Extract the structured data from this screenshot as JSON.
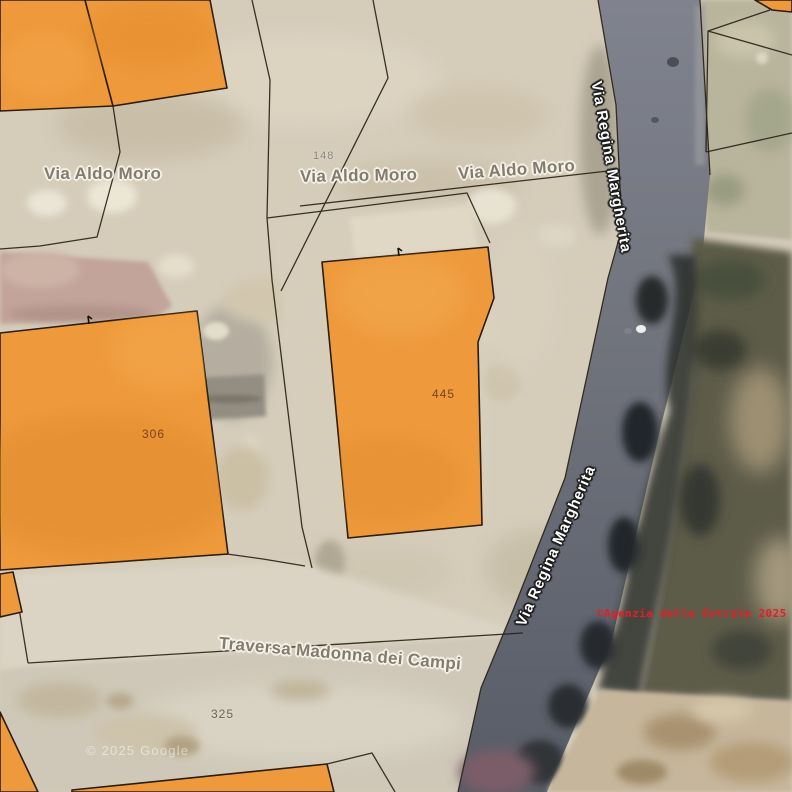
{
  "map": {
    "kind": "cadastral-parcel-overlay-on-satellite",
    "streets": [
      {
        "name": "Via Aldo Moro"
      },
      {
        "name": "Via Regina Margherita"
      },
      {
        "name": "Traversa Madonna dei Campi"
      }
    ],
    "street_labels": [
      {
        "text": "Via Aldo Moro"
      },
      {
        "text": "Via Aldo Moro"
      },
      {
        "text": "Via Aldo Moro"
      },
      {
        "text": "Via Regina Margherita"
      },
      {
        "text": "Via Regina Margherita"
      },
      {
        "text": "Traversa Madonna dei Campi"
      }
    ],
    "parcels": [
      {
        "number": "148"
      },
      {
        "number": "306"
      },
      {
        "number": "445"
      },
      {
        "number": "325"
      }
    ],
    "copyright": "©Agenzia delle Entrate 2025",
    "watermark": "© 2025 Google",
    "colors": {
      "parcel_fill": "#ee9a3c",
      "parcel_border": "#2b1c0c",
      "boundary_line": "#272014",
      "road": "#71747e",
      "copyright_red": "#ea1b23",
      "ground": "#d5ccba"
    }
  }
}
